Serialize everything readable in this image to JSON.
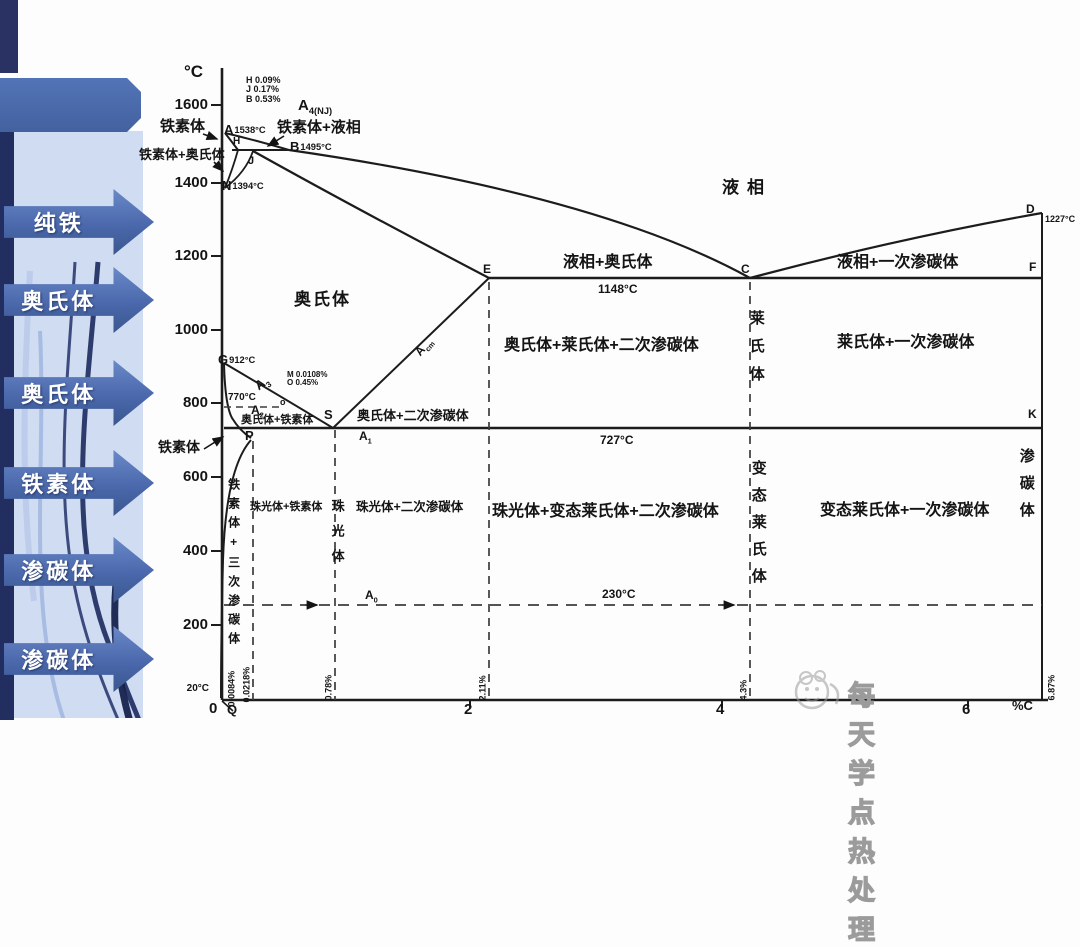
{
  "sidebar": {
    "items": [
      {
        "label": "纯铁"
      },
      {
        "label": "奥氏体"
      },
      {
        "label": "奥氏体"
      },
      {
        "label": "铁素体"
      },
      {
        "label": "渗碳体"
      },
      {
        "label": "渗碳体"
      }
    ]
  },
  "axis": {
    "y_unit": "°C",
    "y_ticks": [
      "1600",
      "1400",
      "1200",
      "1000",
      "800",
      "600",
      "400",
      "200"
    ],
    "room_temp": "20°C",
    "origin": "0",
    "x_ticks": [
      "2",
      "4",
      "6"
    ],
    "x_unit": "%C"
  },
  "legends": {
    "hjb": [
      "H 0.09%",
      "J 0.17%",
      "B 0.53%"
    ],
    "mo": [
      "M 0.0108%",
      "O 0.45%"
    ]
  },
  "points": {
    "A": "A",
    "A_t": "1538°C",
    "B": "B",
    "B_t": "1495°C",
    "N": "N",
    "N_t": "1394°C",
    "G": "G",
    "G_t": "912°C",
    "D": "D",
    "D_t": "1227°C",
    "E": "E",
    "C": "C",
    "F": "F",
    "K": "K",
    "S": "S",
    "P": "P",
    "Q": "Q",
    "H": "H",
    "J": "J",
    "O": "o"
  },
  "line_marks": {
    "a4_main": "A",
    "a4_sub": "4(NJ)",
    "a3_main": "A",
    "a3_sub": "3",
    "acm_main": "A",
    "acm_sub": "cm",
    "a2_main": "A",
    "a2_sub": "2",
    "a1_main": "A",
    "a1_sub": "1",
    "a0_main": "A",
    "a0_sub": "0"
  },
  "isotherms": {
    "t1148": "1148°C",
    "t727": "727°C",
    "t230": "230°C",
    "t770": "770°C"
  },
  "regions": {
    "liquid": "液相",
    "ferrite_top": "铁素体",
    "ferrite_austenite": "铁素体+奥氏体",
    "ferrite_liquid": "铁素体+液相",
    "austenite": "奥氏体",
    "liquid_austenite": "液相+奥氏体",
    "liquid_cem1": "液相+一次渗碳体",
    "aust_led_cem2": "奥氏体+莱氏体+二次渗碳体",
    "ledeburite": "莱氏体",
    "led_cem1": "莱氏体+一次渗碳体",
    "aust_cem2": "奥氏体+二次渗碳体",
    "aust_ferrite_small": "奥氏体+铁素体",
    "ferrite_mid": "铁素体",
    "ferrite_cem3": "铁素体+三次渗碳体",
    "pearlite_ferrite": "珠光体+铁素体",
    "pearlite": "珠光体",
    "pearlite_cem2": "珠光体+二次渗碳体",
    "pearlite_tled_cem2": "珠光体+变态莱氏体+二次渗碳体",
    "t_ledeburite": "变态莱氏体",
    "tled_cem1": "变态莱氏体+一次渗碳体",
    "cementite": "渗碳体"
  },
  "compositions": {
    "c1": "0.0084%",
    "c2": "0.0218%",
    "c3": "0.78%",
    "c4": "2.11%",
    "c5": "4.3%",
    "c6": "6.87%"
  },
  "watermark": {
    "text": "每天学点热处理"
  },
  "phase_diagram": {
    "type": "phase-diagram (Fe-Fe3C)",
    "x_axis": {
      "label": "%C",
      "range": [
        0,
        6.87
      ]
    },
    "y_axis": {
      "label": "°C",
      "range": [
        20,
        1600
      ]
    },
    "key_points": {
      "A": {
        "pctC": 0,
        "tempC": 1538
      },
      "B": {
        "pctC": 0.53,
        "tempC": 1495
      },
      "H": {
        "pctC": 0.09,
        "tempC": 1495
      },
      "J": {
        "pctC": 0.17,
        "tempC": 1495
      },
      "N": {
        "pctC": 0,
        "tempC": 1394
      },
      "G": {
        "pctC": 0,
        "tempC": 912
      },
      "M": {
        "pctC": 0.0108,
        "tempC": 770
      },
      "O": {
        "pctC": 0.45,
        "tempC": 770
      },
      "E": {
        "pctC": 2.11,
        "tempC": 1148
      },
      "C": {
        "pctC": 4.3,
        "tempC": 1148
      },
      "D": {
        "pctC": 6.87,
        "tempC": 1227
      },
      "F": {
        "pctC": 6.87,
        "tempC": 1148
      },
      "S": {
        "pctC": 0.78,
        "tempC": 727
      },
      "P": {
        "pctC": 0.0218,
        "tempC": 727
      },
      "K": {
        "pctC": 6.87,
        "tempC": 727
      },
      "Q": {
        "pctC": 0.0084,
        "tempC": 20
      }
    },
    "isotherms_C": [
      1148,
      727,
      230,
      770
    ]
  }
}
